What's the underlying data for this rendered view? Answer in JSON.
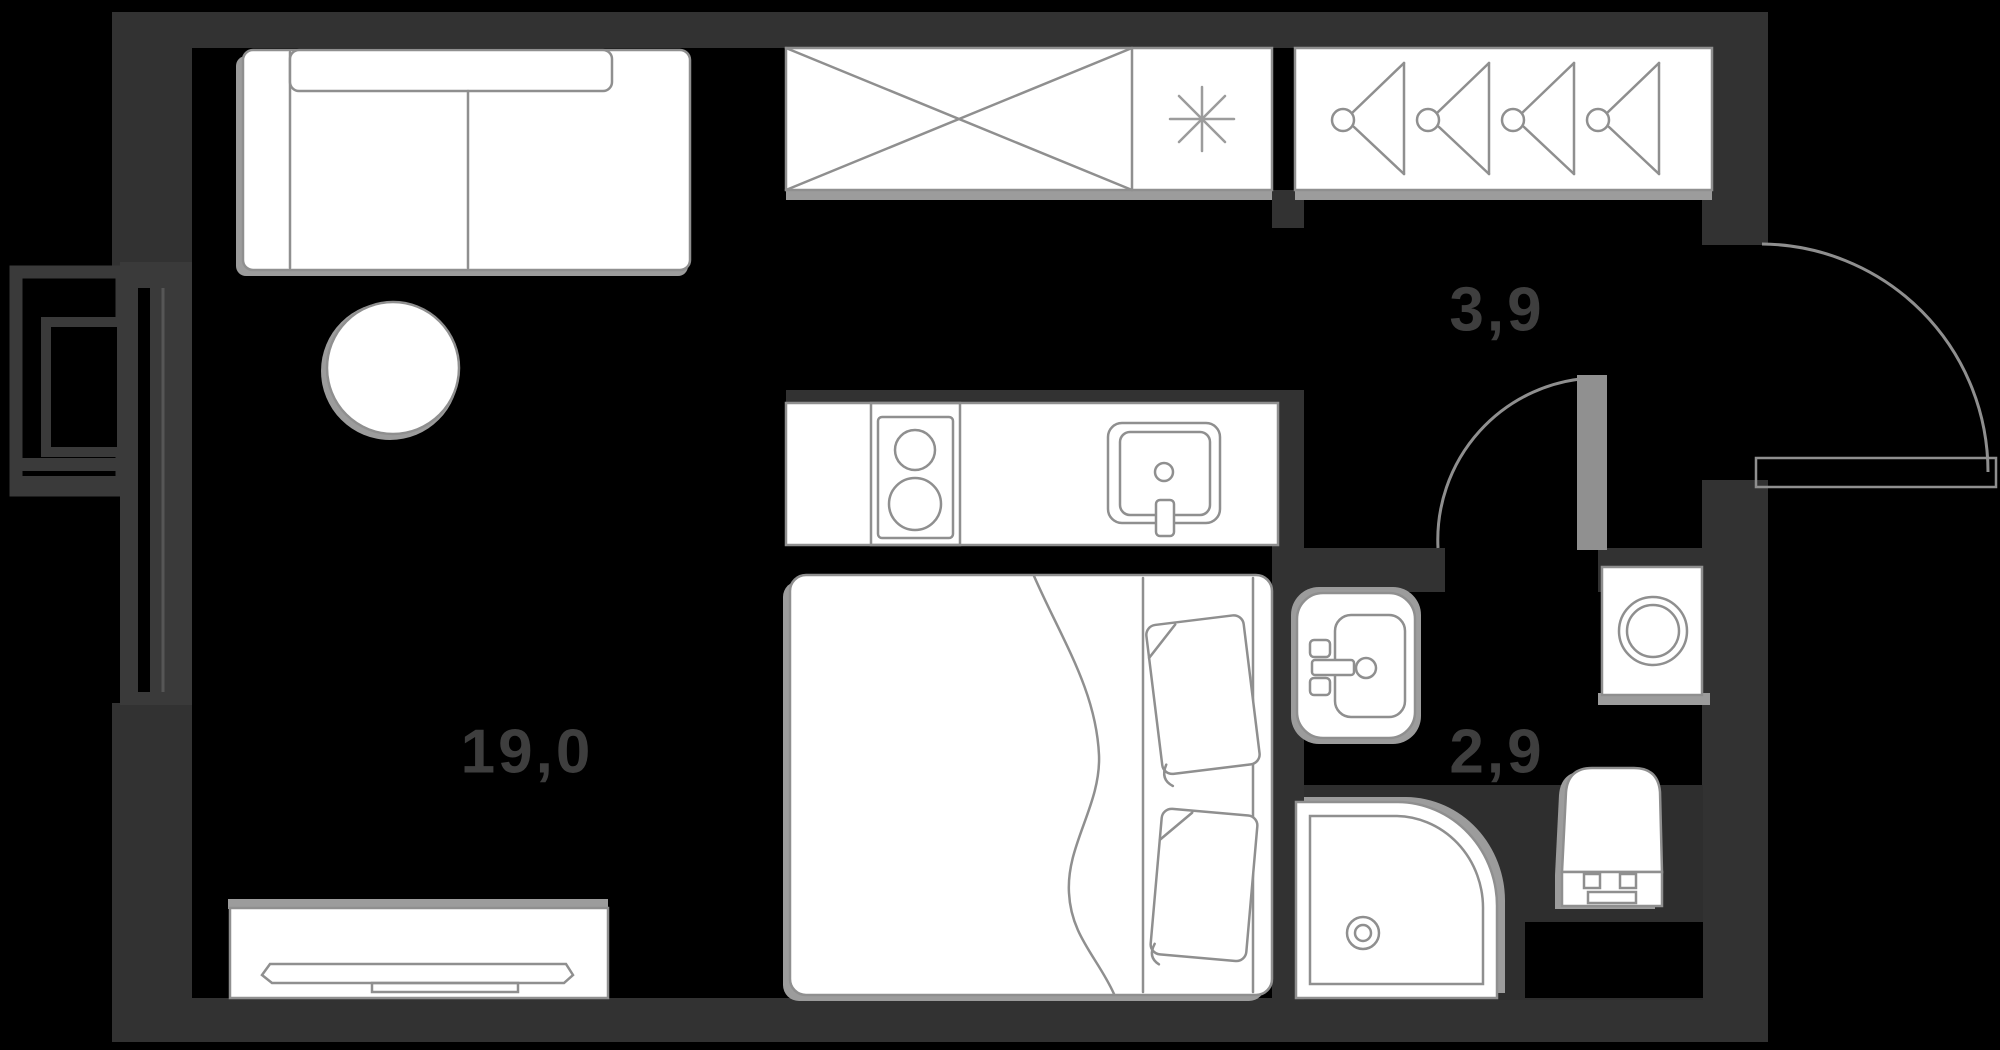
{
  "plan": {
    "type": "apartment-floor-plan",
    "rooms": [
      {
        "id": "living-room",
        "area_label": "19,0"
      },
      {
        "id": "hallway",
        "area_label": "3,9"
      },
      {
        "id": "bathroom",
        "area_label": "2,9"
      }
    ],
    "furniture": [
      "sofa",
      "round-table",
      "wardrobe",
      "refrigerator",
      "closet-hangers",
      "kitchen-counter",
      "stove",
      "kitchen-sink",
      "bed",
      "pillows",
      "blanket",
      "tv-stand",
      "bathroom-sink",
      "shower",
      "toilet",
      "washing-machine"
    ],
    "doors": [
      "entry-door",
      "bathroom-door"
    ],
    "colors": {
      "background": "#000000",
      "wall": "#323232",
      "window_frame": "#3a3a3a",
      "furniture_fill": "#ffffff",
      "furniture_stroke": "#8f8f8f",
      "shadow": "#9c9c9c",
      "label_text": "#3e3e3e",
      "wet_floor": "#2e2e2e"
    }
  }
}
